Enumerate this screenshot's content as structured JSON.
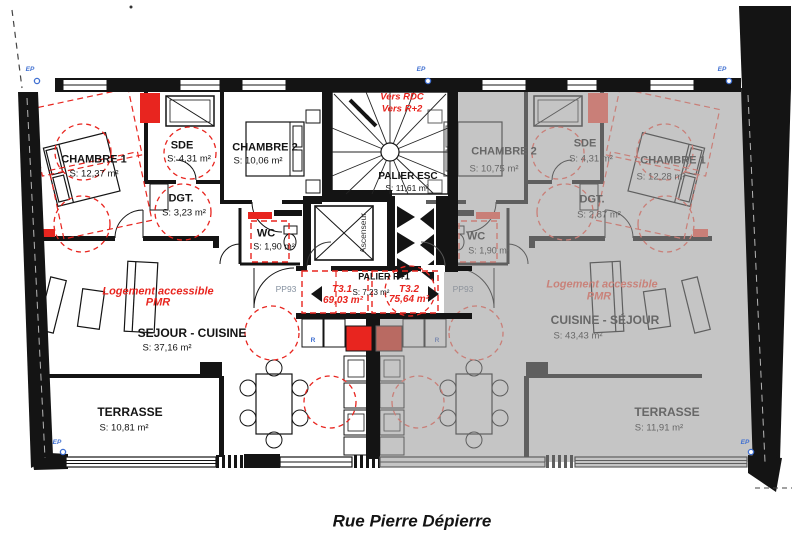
{
  "title": "Rue Pierre Dépierre",
  "stairwell": {
    "direction_note_1": "Vers RDC",
    "direction_note_2": "Vers R+2",
    "palier_esc_name": "PALIER ESC",
    "palier_esc_area": "S: 11,61 m²",
    "elevator_label": "Ascenseur",
    "palier_r1_name": "PALIER R+1",
    "palier_r1_area": "S: 7,23 m²",
    "unit_left_code": "T3.1",
    "unit_left_area": "69,03 m²",
    "unit_right_code": "T3.2",
    "unit_right_area": "75,64 m²"
  },
  "apartment_left": {
    "accessibility_note_1": "Logement accessible",
    "accessibility_note_2": "PMR",
    "chambre1_name": "CHAMBRE 1",
    "chambre1_area": "S: 12,37 m²",
    "sde_name": "SDE",
    "sde_area": "S: 4,31 m²",
    "chambre2_name": "CHAMBRE 2",
    "chambre2_area": "S: 10,06 m²",
    "dgt_name": "DGT.",
    "dgt_area": "S: 3,23 m²",
    "wc_name": "WC",
    "wc_area": "S: 1,90 m²",
    "sejour_name": "SEJOUR - CUISINE",
    "sejour_area": "S: 37,16 m²",
    "terrasse_name": "TERRASSE",
    "terrasse_area": "S: 10,81 m²",
    "door_label": "PP93"
  },
  "apartment_right": {
    "accessibility_note_1": "Logement accessible",
    "accessibility_note_2": "PMR",
    "chambre2_name": "CHAMBRE 2",
    "chambre2_area": "S: 10,75 m²",
    "sde_name": "SDE",
    "sde_area": "S: 4,31 m²",
    "chambre1_name": "CHAMBRE 1",
    "chambre1_area": "S: 12,28 m²",
    "dgt_name": "DGT.",
    "dgt_area": "S: 2,87 m²",
    "wc_name": "WC",
    "wc_area": "S: 1,90 m²",
    "sejour_name": "CUISINE - SÉJOUR",
    "sejour_area": "S: 43,43 m²",
    "terrasse_name": "TERRASSE",
    "terrasse_area": "S: 11,91 m²",
    "door_label": "PP93"
  },
  "annotations": {
    "ep_label": "EP",
    "r_label": "R"
  },
  "colors": {
    "accent_red": "#e8251f",
    "dimmed_red": "#c97f78",
    "dimmed_overlay_gray": "#c5c5c5",
    "line_black": "#141414",
    "dimmed_line_gray": "#5f5f5f",
    "ep_blue": "#3f6fd1"
  }
}
